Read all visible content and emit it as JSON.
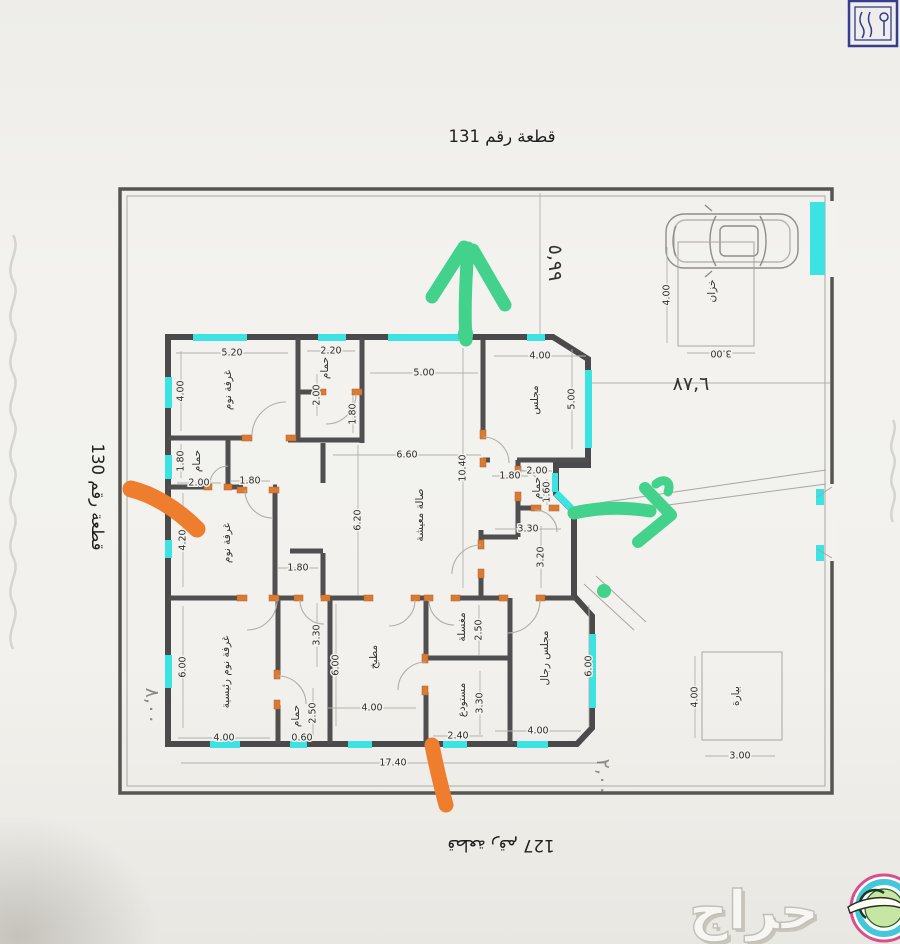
{
  "page": {
    "plot_title_top": "قطعة رقم 131",
    "plot_label_left": "قطعة رقم 130",
    "plot_label_bottom": "قطعة رقم 127",
    "handwritten": {
      "street_width": "٥,٩٩",
      "right_offset": "٨٧,٦",
      "left_offset": "٨,٠٠",
      "bottom_offset": "٢,٠٠"
    }
  },
  "watermark": {
    "brand": "حراج"
  },
  "colors": {
    "window_cyan": "#3be3e3",
    "marker_orange": "#ef7d2e",
    "marker_green": "#42d28c",
    "wall_gray": "#4a4a4a",
    "door_orange": "#d97a35",
    "stamp_blue": "#343d8f"
  },
  "rooms": [
    {
      "label": "غرفة نوم",
      "x": 228,
      "y": 390
    },
    {
      "label": "حمام",
      "x": 325,
      "y": 368
    },
    {
      "label": "حمام",
      "x": 197,
      "y": 461
    },
    {
      "label": "صالة معيشة",
      "x": 420,
      "y": 515
    },
    {
      "label": "مجلس",
      "x": 535,
      "y": 400
    },
    {
      "label": "حمام",
      "x": 537,
      "y": 488
    },
    {
      "label": "غرفة نوم",
      "x": 227,
      "y": 543
    },
    {
      "label": "غرفة نوم رئيسية",
      "x": 226,
      "y": 672
    },
    {
      "label": "حمام",
      "x": 296,
      "y": 716
    },
    {
      "label": "مطبخ",
      "x": 374,
      "y": 657
    },
    {
      "label": "مغسلة",
      "x": 462,
      "y": 627
    },
    {
      "label": "مستودع",
      "x": 462,
      "y": 700
    },
    {
      "label": "مجلس رجال",
      "x": 545,
      "y": 658
    },
    {
      "label": "خزان",
      "x": 712,
      "y": 291
    },
    {
      "label": "بيارة",
      "x": 736,
      "y": 696
    }
  ],
  "dimensions": [
    {
      "text": "5.20",
      "x": 232,
      "y": 353,
      "rot": 0,
      "len": 112
    },
    {
      "text": "4.00",
      "x": 181,
      "y": 391,
      "rot": -90,
      "len": 80
    },
    {
      "text": "2.20",
      "x": 331,
      "y": 351,
      "rot": 0,
      "len": 48
    },
    {
      "text": "2.00",
      "x": 317,
      "y": 395,
      "rot": -90,
      "len": 42
    },
    {
      "text": "1.80",
      "x": 353,
      "y": 414,
      "rot": -90,
      "len": 38
    },
    {
      "text": "5.00",
      "x": 424,
      "y": 373,
      "rot": 0,
      "len": 108
    },
    {
      "text": "6.60",
      "x": 407,
      "y": 455,
      "rot": 0,
      "len": 148
    },
    {
      "text": "10.40",
      "x": 463,
      "y": 468,
      "rot": -90,
      "len": 240
    },
    {
      "text": "6.20",
      "x": 358,
      "y": 520,
      "rot": -90,
      "len": 150
    },
    {
      "text": "1.80",
      "x": 181,
      "y": 461,
      "rot": -90,
      "len": 34
    },
    {
      "text": "2.00",
      "x": 199,
      "y": 483,
      "rot": 0,
      "len": 44
    },
    {
      "text": "1.80",
      "x": 250,
      "y": 481,
      "rot": 0,
      "len": 40
    },
    {
      "text": "4.20",
      "x": 183,
      "y": 540,
      "rot": -90,
      "len": 94
    },
    {
      "text": "1.80",
      "x": 298,
      "y": 568,
      "rot": 0,
      "len": 40
    },
    {
      "text": "4.00",
      "x": 540,
      "y": 356,
      "rot": 0,
      "len": 92
    },
    {
      "text": "5.00",
      "x": 572,
      "y": 399,
      "rot": -90,
      "len": 100
    },
    {
      "text": "1.80",
      "x": 510,
      "y": 476,
      "rot": 0,
      "len": 36
    },
    {
      "text": "2.00",
      "x": 537,
      "y": 471,
      "rot": 0,
      "len": 30
    },
    {
      "text": "1.60",
      "x": 547,
      "y": 492,
      "rot": -90,
      "len": 26
    },
    {
      "text": "3.30",
      "x": 528,
      "y": 529,
      "rot": 0,
      "len": 66
    },
    {
      "text": "3.20",
      "x": 541,
      "y": 557,
      "rot": -90,
      "len": 62
    },
    {
      "text": "6.00",
      "x": 183,
      "y": 667,
      "rot": -90,
      "len": 122
    },
    {
      "text": "4.00",
      "x": 224,
      "y": 738,
      "rot": 0,
      "len": 92
    },
    {
      "text": "3.30",
      "x": 317,
      "y": 635,
      "rot": -90,
      "len": 64
    },
    {
      "text": "2.50",
      "x": 313,
      "y": 713,
      "rot": -90,
      "len": 50
    },
    {
      "text": "0.60",
      "x": 302,
      "y": 738,
      "rot": 0,
      "len": 22
    },
    {
      "text": "6.00",
      "x": 336,
      "y": 665,
      "rot": -90,
      "len": 122
    },
    {
      "text": "4.00",
      "x": 372,
      "y": 708,
      "rot": 0,
      "len": 88
    },
    {
      "text": "2.50",
      "x": 479,
      "y": 630,
      "rot": -90,
      "len": 50
    },
    {
      "text": "3.30",
      "x": 480,
      "y": 703,
      "rot": -90,
      "len": 64
    },
    {
      "text": "2.40",
      "x": 458,
      "y": 736,
      "rot": 0,
      "len": 50
    },
    {
      "text": "6.00",
      "x": 589,
      "y": 666,
      "rot": -90,
      "len": 122
    },
    {
      "text": "4.00",
      "x": 538,
      "y": 731,
      "rot": 0,
      "len": 86
    },
    {
      "text": "17.40",
      "x": 393,
      "y": 763,
      "rot": 0,
      "len": 424
    },
    {
      "text": "4.00",
      "x": 667,
      "y": 295,
      "rot": -90,
      "len": 96
    },
    {
      "text": "3.00",
      "x": 721,
      "y": 353,
      "rot": 180,
      "len": 68
    },
    {
      "text": "4.00",
      "x": 695,
      "y": 697,
      "rot": -90,
      "len": 82
    },
    {
      "text": "3.00",
      "x": 740,
      "y": 756,
      "rot": 0,
      "len": 70
    }
  ]
}
